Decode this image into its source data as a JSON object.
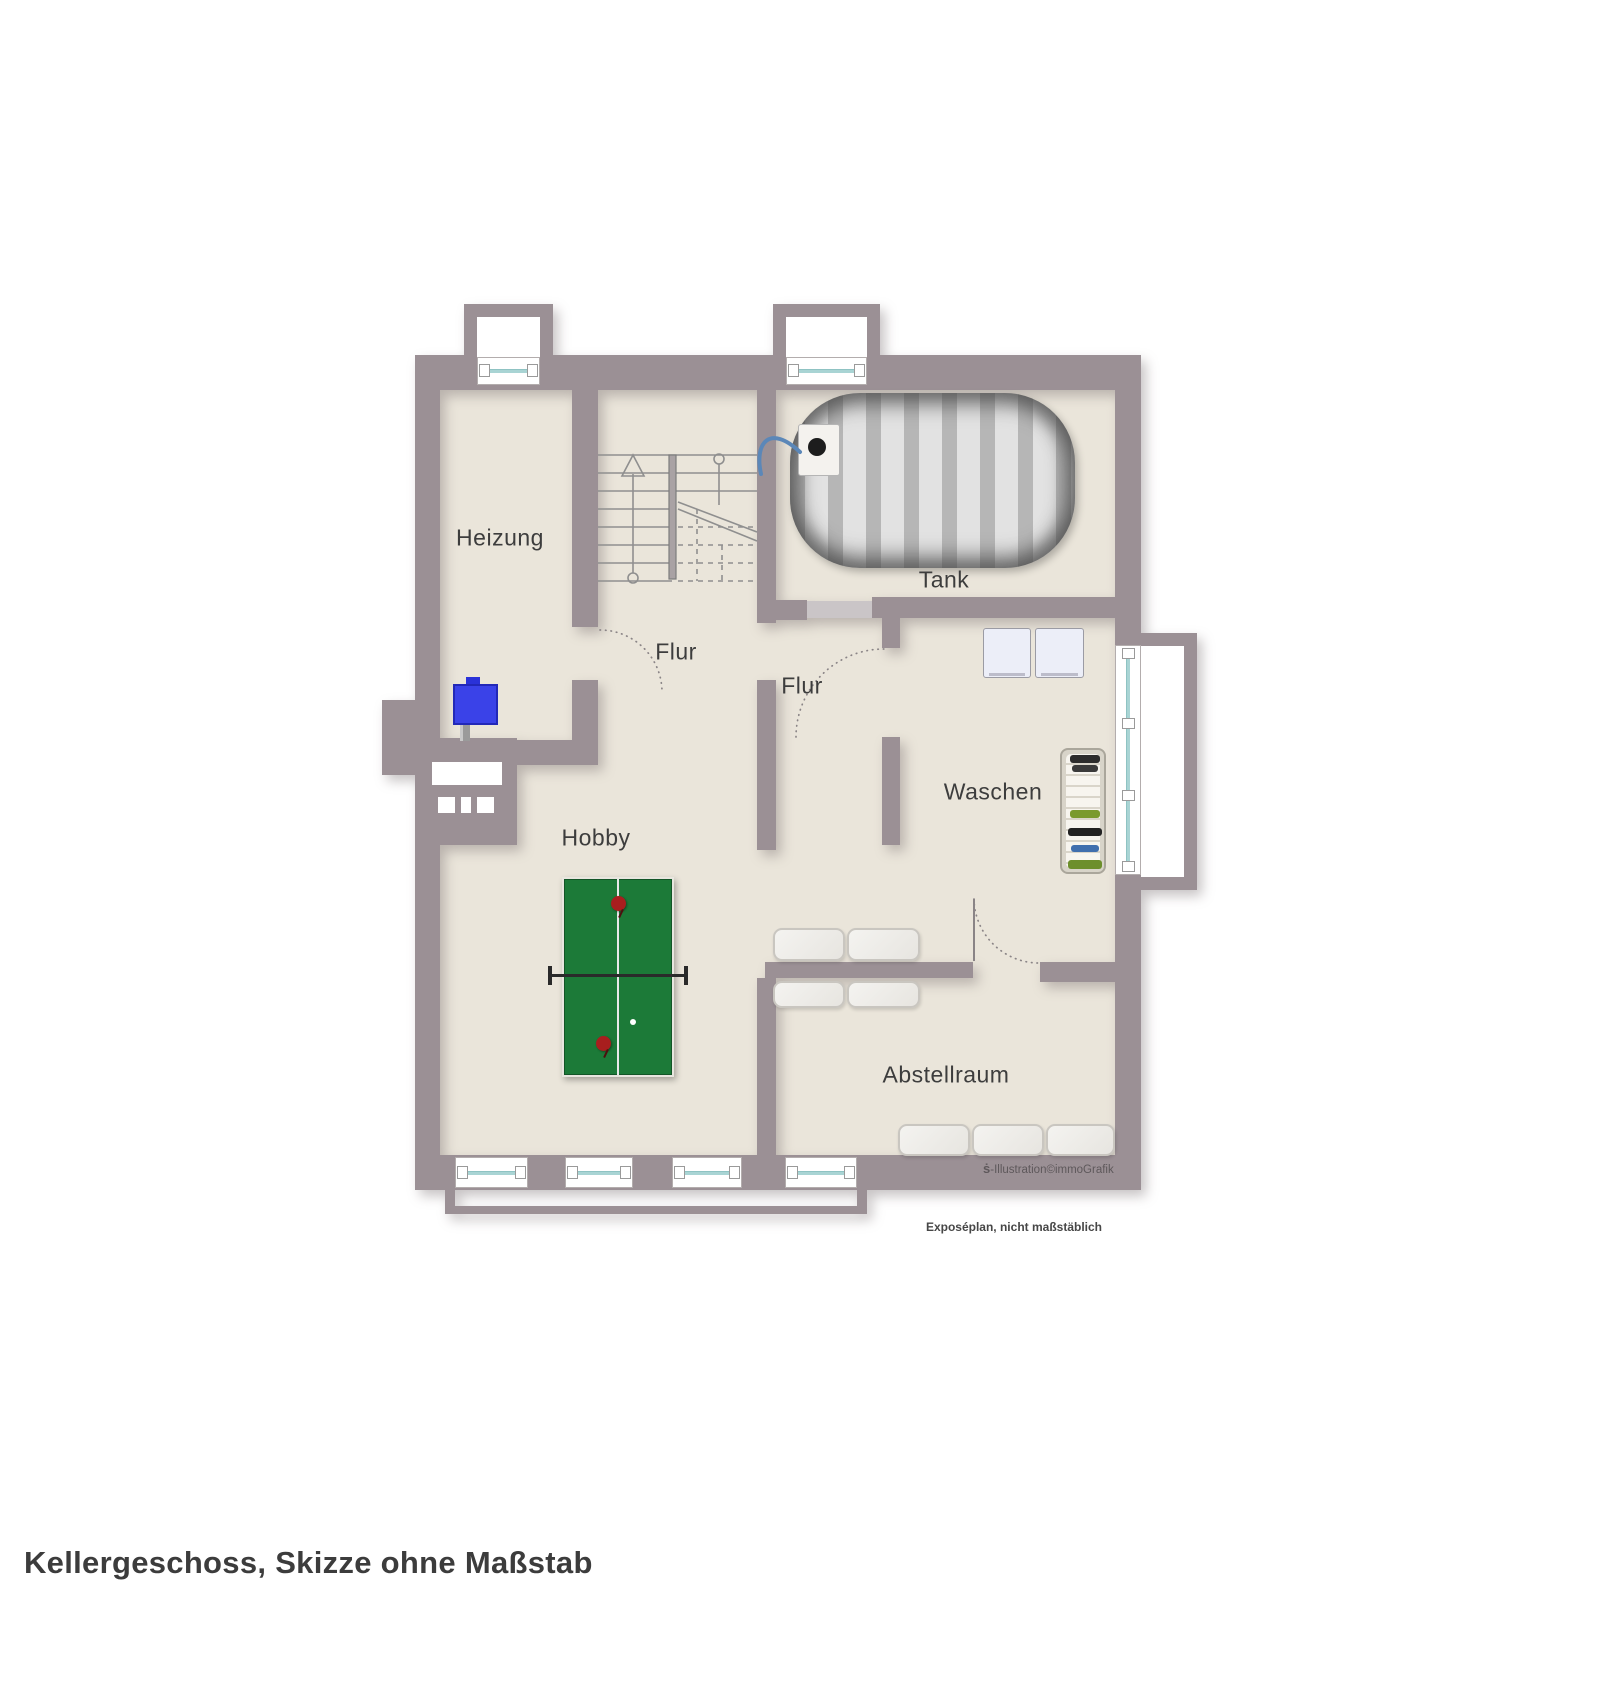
{
  "page": {
    "title": "Kellergeschoss, Skizze ohne Maßstab",
    "note": "Exposéplan, nicht maßstäblich",
    "watermark_logo": "ṡ",
    "watermark_text": "-Illustration©immoGrafik"
  },
  "rooms": {
    "heizung": "Heizung",
    "flur_upper": "Flur",
    "flur_lower": "Flur",
    "tank": "Tank",
    "waschen": "Waschen",
    "hobby": "Hobby",
    "abstellraum": "Abstellraum"
  },
  "colors": {
    "wall": "#9b9095",
    "wall_light": "#cac5c7",
    "floor": "#eae5da",
    "window_glass": "#a9d4d4",
    "table_green": "#1c7a38",
    "paddle_red": "#a81e1e",
    "boiler_blue": "#3a42e8",
    "tank_gray": "#c9c9c9"
  }
}
